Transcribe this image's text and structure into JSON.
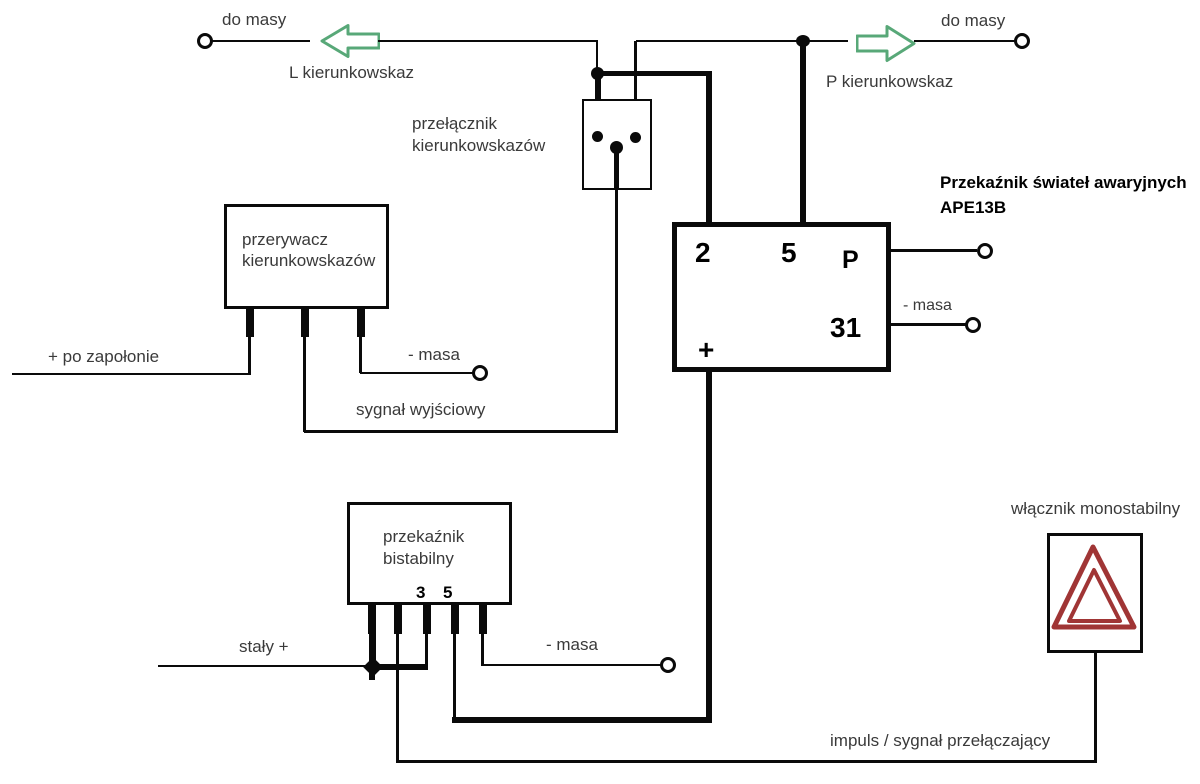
{
  "top_left": {
    "ground": "do masy",
    "indicator": "L kierunkowskaz"
  },
  "top_right": {
    "ground": "do masy",
    "indicator": "P kierunkowskaz"
  },
  "turn_switch": {
    "line1": "przełącznik",
    "line2": "kierunkowskazów"
  },
  "flasher": {
    "line1": "przerywacz",
    "line2": "kierunkowskazów",
    "ignition": "+ po zapołonie",
    "ground": "- masa",
    "output": "sygnał wyjściowy"
  },
  "hazard_relay": {
    "title": "Przekaźnik świateł awaryjnych",
    "model": "APE13B",
    "pin_2": "2",
    "pin_5": "5",
    "pin_p": "P",
    "pin_31": "31",
    "pin_plus": "+",
    "ground": "- masa"
  },
  "bistable": {
    "line1": "przekaźnik",
    "line2": "bistabilny",
    "pin_3": "3",
    "pin_5": "5",
    "constant_plus": "stały +",
    "ground": "- masa"
  },
  "monostable": {
    "label": "włącznik monostabilny"
  },
  "bottom": {
    "impulse": "impuls / sygnał przełączający"
  },
  "colors": {
    "wire": "#0a0a0a",
    "arrow_green": "#58a878",
    "hazard_red": "#a03535",
    "label_text": "#3a3a3a",
    "background": "#ffffff"
  }
}
